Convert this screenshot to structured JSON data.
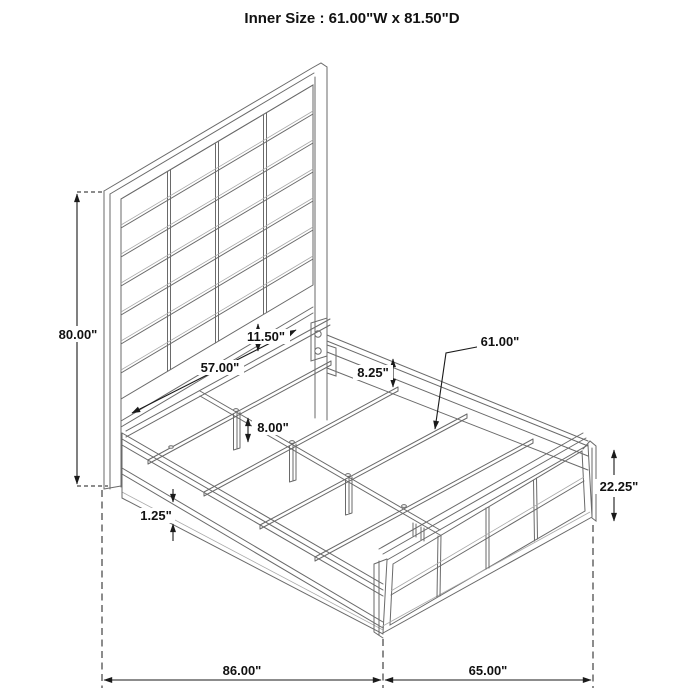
{
  "title": "Inner Size : 61.00\"W x 81.50\"D",
  "inner_size": {
    "width_in": 61.0,
    "depth_in": 81.5
  },
  "dimensions": {
    "overall_height": "80.00\"",
    "headboard_slat_span": "57.00\"",
    "headboard_rail_height": "11.50\"",
    "side_rail_height": "8.25\"",
    "inner_width": "61.00\"",
    "support_leg_height": "8.00\"",
    "rail_trim_thickness": "1.25\"",
    "footboard_height": "22.25\"",
    "overall_depth": "86.00\"",
    "overall_width": "65.00\""
  },
  "colors": {
    "background": "#ffffff",
    "structure_line": "#6a6a6a",
    "dimension_line": "#1a1a1a",
    "text": "#111111"
  }
}
